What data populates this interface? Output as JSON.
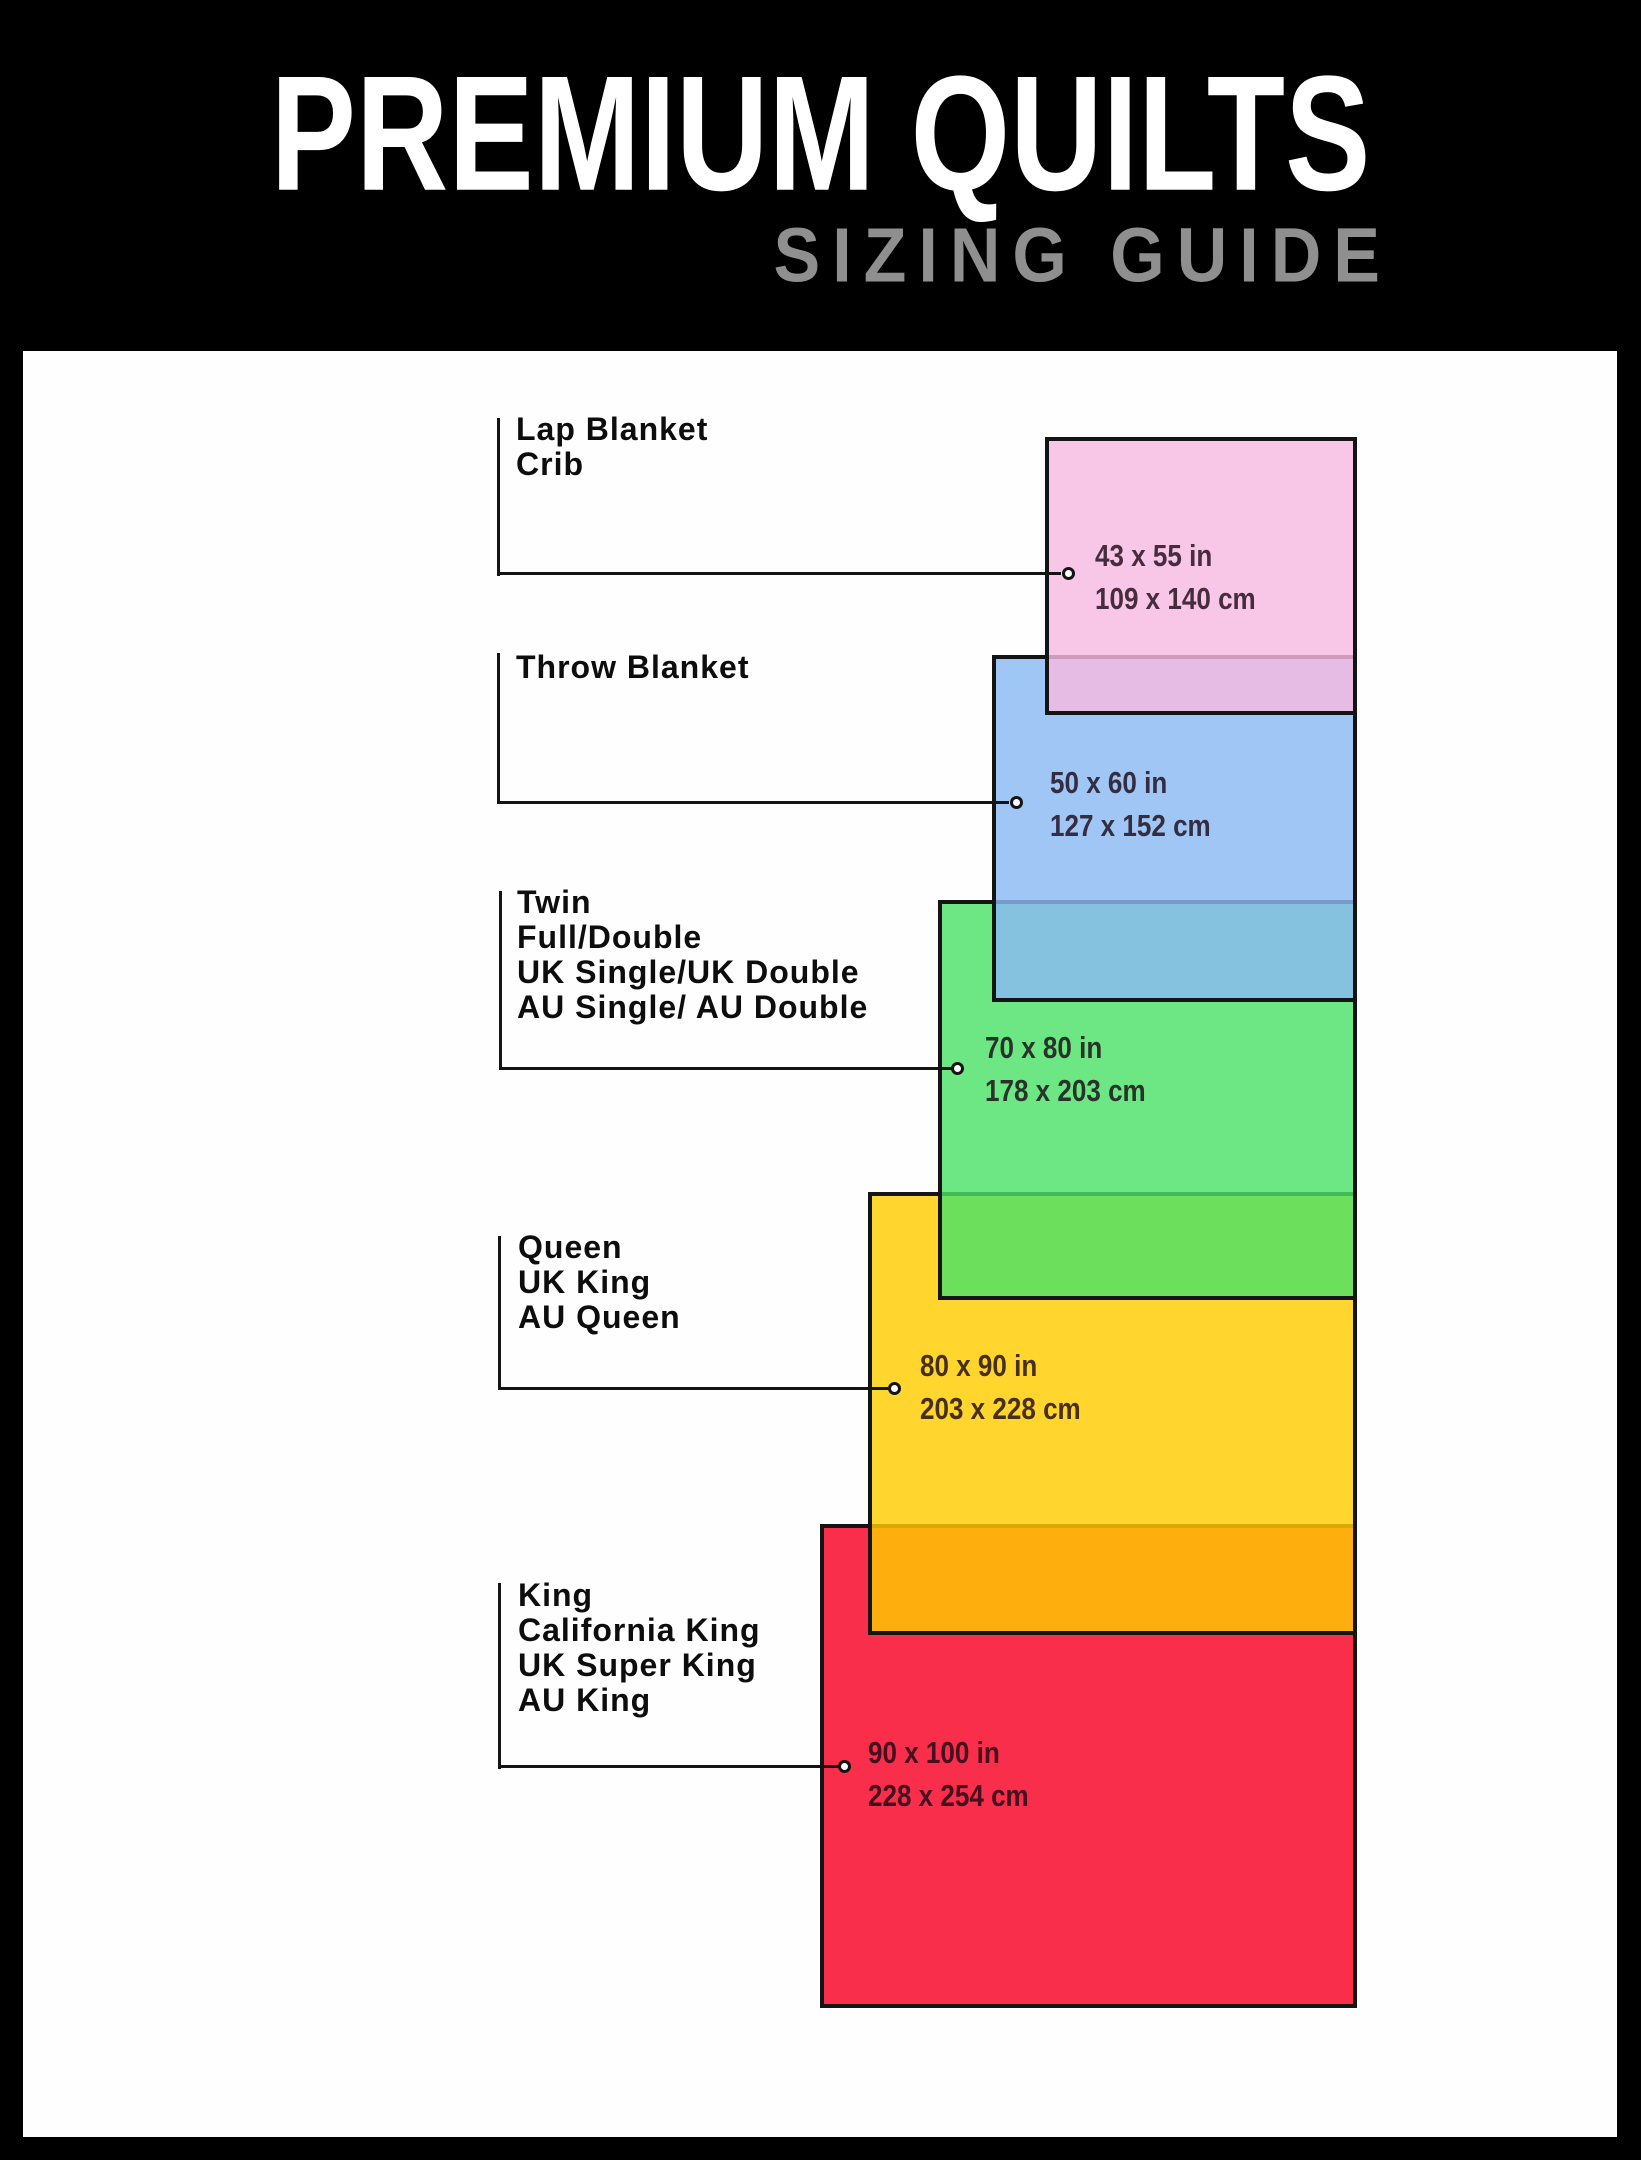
{
  "header": {
    "title": "PREMIUM QUILTS",
    "subtitle": "SIZING GUIDE",
    "background": "#000000",
    "title_color": "#ffffff",
    "subtitle_color": "#8f8f8f"
  },
  "panel_color": "#fefefe",
  "line_color": "#141414",
  "items": [
    {
      "name_lines": [
        "Lap Blanket",
        "Crib"
      ],
      "inches": "43 x 55 in",
      "cm": "109 x 140 cm",
      "fill": "#f7b9e1"
    },
    {
      "name_lines": [
        "Throw Blanket"
      ],
      "inches": "50 x 60 in",
      "cm": "127 x 152 cm",
      "fill": "#8abaf3"
    },
    {
      "name_lines": [
        "Twin",
        "Full/Double",
        "UK Single/UK Double",
        "AU Single/ AU Double"
      ],
      "inches": "70 x 80 in",
      "cm": "178 x 203 cm",
      "fill": "#4ce268"
    },
    {
      "name_lines": [
        "Queen",
        "UK King",
        "AU Queen"
      ],
      "inches": "80 x 90 in",
      "cm": "203 x 228 cm",
      "fill": "#ffcc00"
    },
    {
      "name_lines": [
        "King",
        "California King",
        "UK Super King",
        "AU King"
      ],
      "inches": "90 x 100 in",
      "cm": "228 x 254 cm",
      "fill": "#f60022"
    }
  ]
}
